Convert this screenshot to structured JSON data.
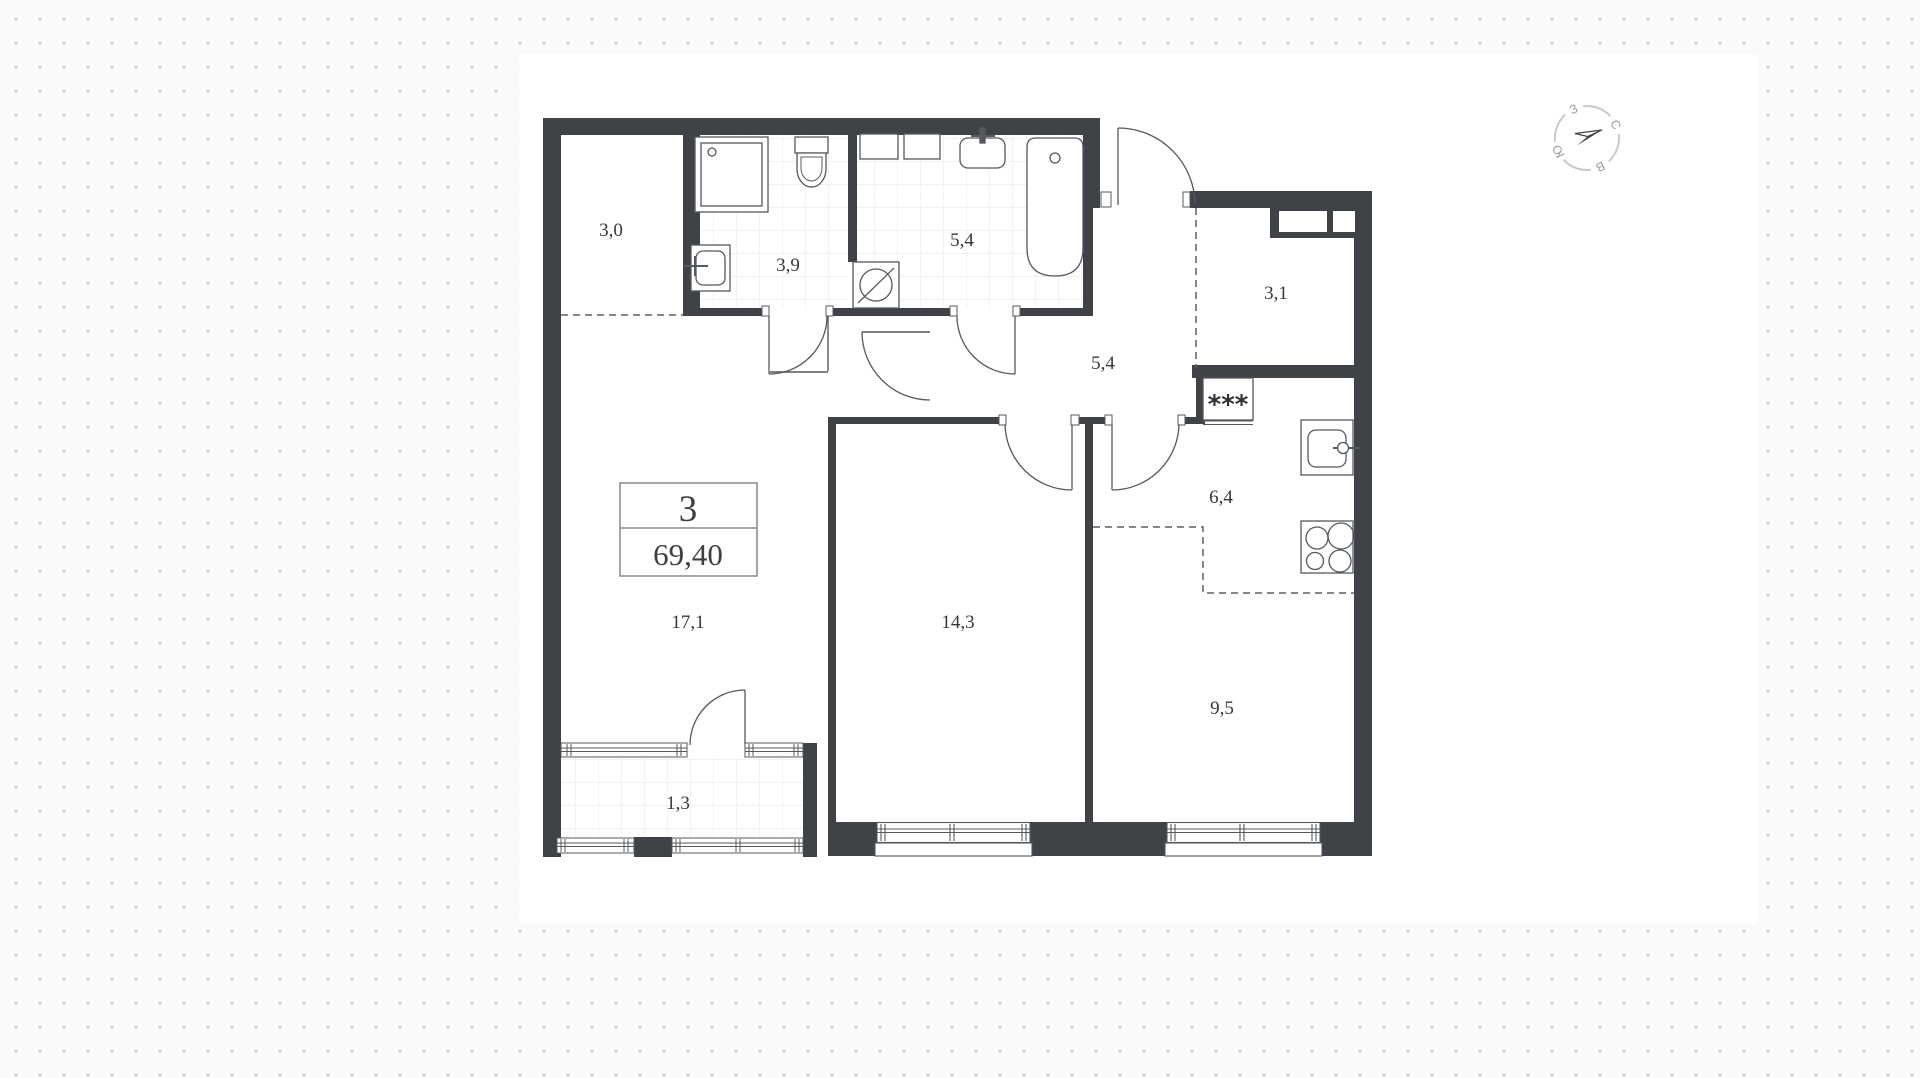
{
  "plan": {
    "unit": {
      "rooms": "3",
      "area": "69,40"
    },
    "rooms": [
      {
        "name": "wardrobe",
        "area": "3,0"
      },
      {
        "name": "bathroom-1",
        "area": "3,9"
      },
      {
        "name": "bathroom-2",
        "area": "5,4"
      },
      {
        "name": "storage",
        "area": "3,1"
      },
      {
        "name": "hallway",
        "area": "5,4"
      },
      {
        "name": "kitchen",
        "area": "6,4"
      },
      {
        "name": "living-room",
        "area": "17,1"
      },
      {
        "name": "bedroom",
        "area": "14,3"
      },
      {
        "name": "room",
        "area": "9,5"
      },
      {
        "name": "balcony",
        "area": "1,3"
      }
    ],
    "vent_label": "***",
    "compass": {
      "north": "С",
      "east": "В",
      "south": "Ю",
      "west": "З"
    },
    "colors": {
      "wall": "#3f4347",
      "thin_line": "#55585c",
      "tile": "#ececec",
      "dot": "#cccccc"
    }
  }
}
